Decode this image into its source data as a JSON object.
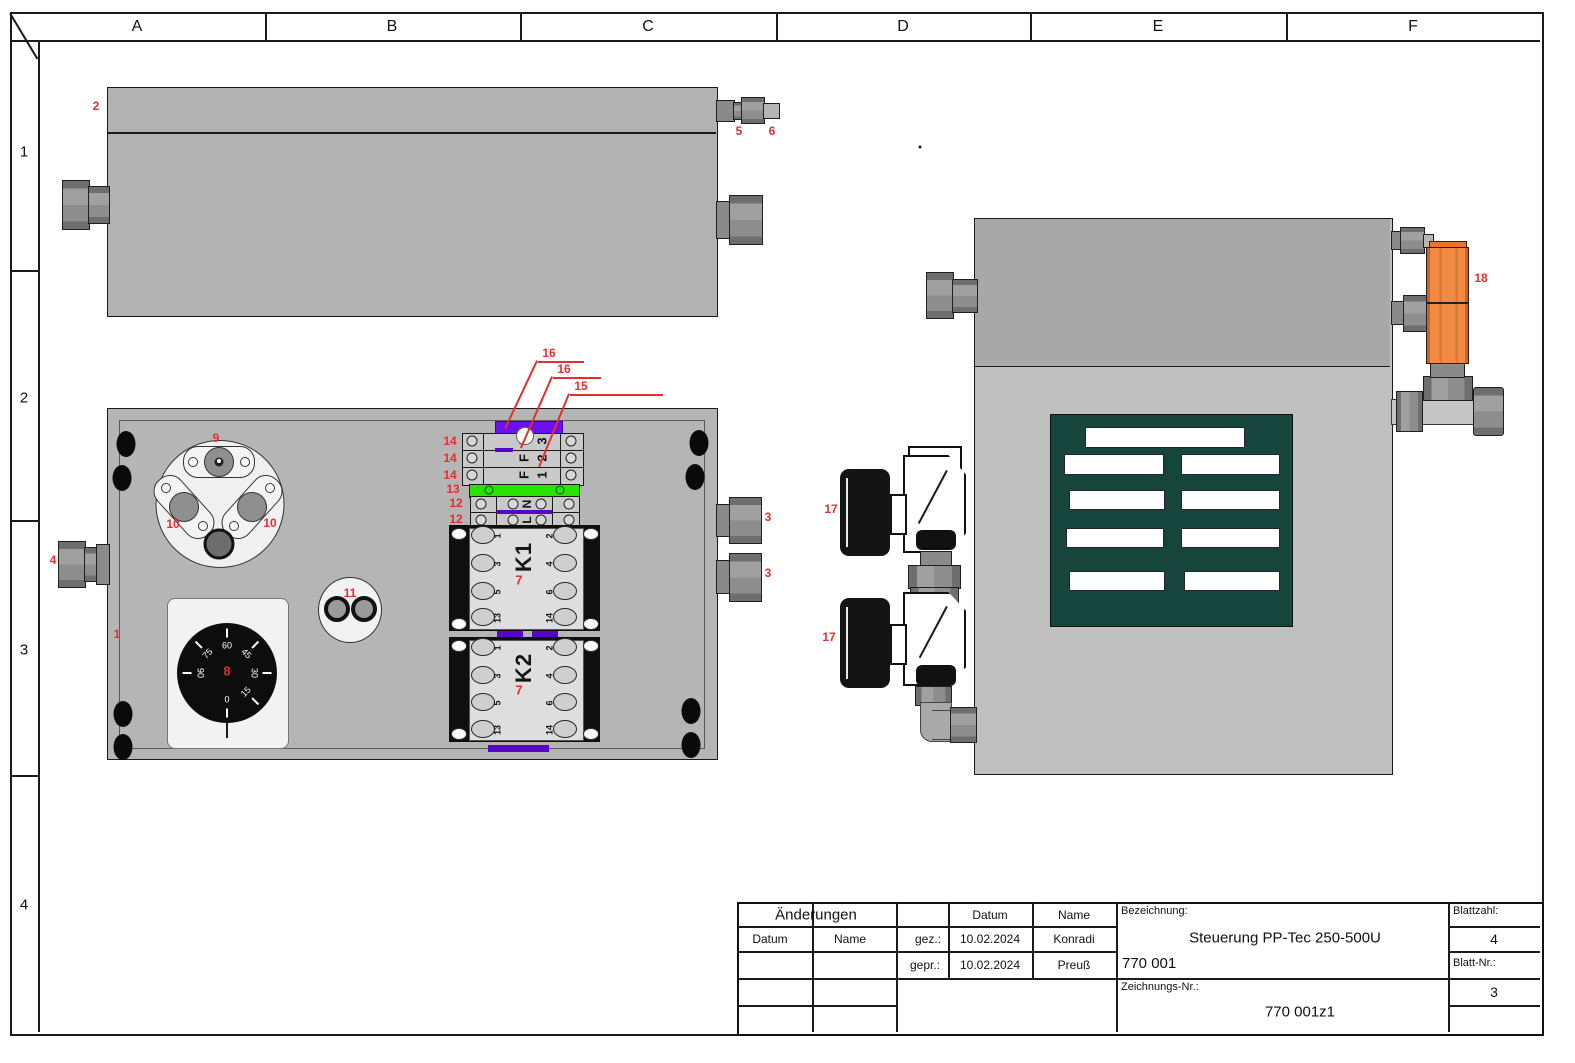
{
  "sheet": {
    "columns": [
      "A",
      "B",
      "C",
      "D",
      "E",
      "F"
    ],
    "rows": [
      "1",
      "2",
      "3",
      "4"
    ]
  },
  "title_block": {
    "aenderungen": "Änderungen",
    "datum_label": "Datum",
    "name_label": "Name",
    "datum_header": "Datum",
    "name_header": "Name",
    "gez_label": "gez.:",
    "gepr_label": "gepr.:",
    "gez_datum": "10.02.2024",
    "gez_name": "Konradi",
    "gepr_datum": "10.02.2024",
    "gepr_name": "Preuß",
    "bezeichnung_label": "Bezeichnung:",
    "bezeichnung_title": "Steuerung PP-Tec 250-500U",
    "bezeichnung_number": "770 001",
    "zeichnungs_label": "Zeichnungs-Nr.:",
    "zeichnungs_number": "770 001z1",
    "blattzahl_label": "Blattzahl:",
    "blattzahl_value": "4",
    "blattnr_label": "Blatt-Nr.:",
    "blattnr_value": "3"
  },
  "callouts": {
    "n1": "1",
    "n2": "2",
    "n3": "3",
    "n4": "4",
    "n5": "5",
    "n6": "6",
    "n7": "7",
    "n8": "8",
    "n9": "9",
    "n10": "10",
    "n11": "11",
    "n12": "12",
    "n13": "13",
    "n14": "14",
    "n15": "15",
    "n16": "16",
    "n17": "17",
    "n18": "18"
  },
  "terminals": {
    "fuse_letters": [
      "F",
      "F",
      "F"
    ],
    "fuse_numbers": [
      "3",
      "2",
      "1"
    ],
    "power_letters": [
      "N",
      "L"
    ]
  },
  "relays": {
    "k1_label": "K1",
    "k2_label": "K2",
    "pins_left": [
      "1",
      "3",
      "5",
      "13"
    ],
    "pins_right": [
      "2",
      "4",
      "6",
      "14"
    ]
  },
  "dial": {
    "labels": [
      "0",
      "15",
      "30",
      "45",
      "60",
      "75",
      "90"
    ]
  },
  "colors": {
    "callout_red": "#e03030",
    "terminal_green": "#2ae202",
    "fuse_purple": "#6c10ee",
    "strip_purple": "#5506c8",
    "vent_teal": "#15453b",
    "orange": "#f18a43"
  }
}
